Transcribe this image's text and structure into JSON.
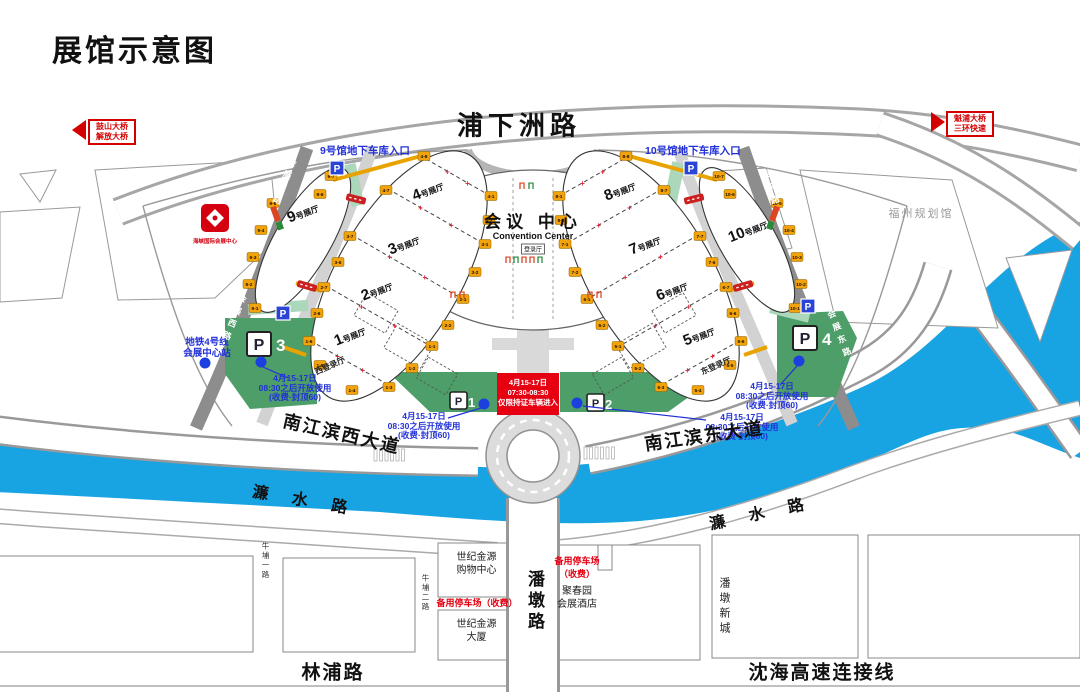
{
  "title": "展馆示意图",
  "signs": {
    "left": {
      "lines": [
        "鼓山大桥",
        "解放大桥"
      ]
    },
    "right": {
      "lines": [
        "魁浦大桥",
        "三环快速"
      ]
    }
  },
  "roads": {
    "puxiazhou": "浦下洲路",
    "njb_west": "南江滨西大道",
    "njb_east": "南江滨东大道",
    "lianshui": "濂水路",
    "linpu": "林浦路",
    "shenhai": "沈海高速连接线"
  },
  "center": {
    "cn": "会议 中心",
    "en": "Convention Center",
    "hall": "登录厅"
  },
  "entrances": {
    "west": "9号馆地下车库入口",
    "east": "10号馆地下车库入口"
  },
  "metro": {
    "lines": [
      "地铁4号线",
      "会展中心站"
    ]
  },
  "notice": {
    "lines": [
      "4月15-17日",
      "07:30-08:30",
      "仅限持证车辆进入"
    ]
  },
  "parking_note": {
    "lines": [
      "4月15-17日",
      "08:30之后开放使用",
      "(收费·封顶60)"
    ]
  },
  "parking": {
    "symbol": "P",
    "p1": "1",
    "p2": "2",
    "p3": "3",
    "p4": "4"
  },
  "buildings": {
    "planning": "福州规划馆",
    "shopping": [
      "世纪金源",
      "购物中心"
    ],
    "tower": [
      "世纪金源",
      "大厦"
    ],
    "hotel": [
      "聚春园",
      "会展酒店"
    ],
    "backup_h": "备用停车场（收费）",
    "backup_v": [
      "备用停车场",
      "（收费）"
    ]
  },
  "logo": {
    "caption": "海峡国际会展中心"
  },
  "colors": {
    "river": "#18A3E3",
    "green": "#4D9E68",
    "green_light": "#ABD7BA",
    "red": "#E60012",
    "blue_text": "#2230D8",
    "road_dark": "#8D8D8D",
    "gate_yellow": "#F2A20A"
  },
  "map": {
    "halls": [
      {
        "num": "9",
        "suffix": "号展厅",
        "x": 303,
        "y": 213,
        "rot": -22
      },
      {
        "num": "4",
        "suffix": "号展厅",
        "x": 428,
        "y": 191,
        "rot": -22
      },
      {
        "num": "3",
        "suffix": "号展厅",
        "x": 404,
        "y": 245,
        "rot": -22
      },
      {
        "num": "2",
        "suffix": "号展厅",
        "x": 377,
        "y": 291,
        "rot": -22
      },
      {
        "num": "1",
        "suffix": "号展厅",
        "x": 350,
        "y": 336,
        "rot": -22
      },
      {
        "num": "8",
        "suffix": "号展厅",
        "x": 620,
        "y": 191,
        "rot": -22
      },
      {
        "num": "7",
        "suffix": "号展厅",
        "x": 645,
        "y": 245,
        "rot": -22
      },
      {
        "num": "6",
        "suffix": "号展厅",
        "x": 672,
        "y": 291,
        "rot": -22
      },
      {
        "num": "5",
        "suffix": "号展厅",
        "x": 699,
        "y": 336,
        "rot": -22
      },
      {
        "num": "10",
        "suffix": "号展厅",
        "x": 748,
        "y": 231,
        "rot": -22
      }
    ],
    "reg_labels": [
      {
        "text": "西登录厅",
        "x": 330,
        "y": 366,
        "rot": -24
      },
      {
        "text": "东登录厅",
        "x": 716,
        "y": 366,
        "rot": -24
      }
    ],
    "dividers": [
      [
        426,
        159,
        487,
        194
      ],
      [
        388,
        189,
        481,
        242
      ],
      [
        352,
        235,
        459,
        297
      ],
      [
        326,
        286,
        427,
        344
      ],
      [
        311,
        341,
        387,
        384
      ],
      [
        624,
        159,
        563,
        194
      ],
      [
        662,
        189,
        569,
        242
      ],
      [
        698,
        235,
        591,
        297
      ],
      [
        724,
        286,
        623,
        344
      ],
      [
        739,
        341,
        663,
        384
      ]
    ],
    "corridors": [
      [
        333,
        180,
        421,
        156
      ],
      [
        296,
        283,
        322,
        291
      ],
      [
        283,
        347,
        306,
        355
      ],
      [
        717,
        180,
        629,
        156
      ],
      [
        754,
        283,
        728,
        291
      ],
      [
        767,
        347,
        744,
        355
      ]
    ],
    "red_bars": [
      {
        "x": 356,
        "y": 199,
        "rot": 14
      },
      {
        "x": 307,
        "y": 286,
        "rot": 16
      },
      {
        "x": 694,
        "y": 199,
        "rot": -14
      },
      {
        "x": 743,
        "y": 286,
        "rot": -16
      }
    ],
    "gates": [
      {
        "l": "9-1",
        "x": 255,
        "y": 308
      },
      {
        "l": "9-2",
        "x": 249,
        "y": 284
      },
      {
        "l": "9-3",
        "x": 253,
        "y": 257
      },
      {
        "l": "9-4",
        "x": 261,
        "y": 230
      },
      {
        "l": "9-5",
        "x": 273,
        "y": 203
      },
      {
        "l": "9-6",
        "x": 320,
        "y": 194
      },
      {
        "l": "9-7",
        "x": 331,
        "y": 176
      },
      {
        "l": "4-8",
        "x": 424,
        "y": 156
      },
      {
        "l": "4-7",
        "x": 386,
        "y": 190
      },
      {
        "l": "4-1",
        "x": 491,
        "y": 196
      },
      {
        "l": "4-2",
        "x": 489,
        "y": 220
      },
      {
        "l": "3-7",
        "x": 350,
        "y": 236
      },
      {
        "l": "3-6",
        "x": 338,
        "y": 262
      },
      {
        "l": "3-1",
        "x": 485,
        "y": 244
      },
      {
        "l": "3-2",
        "x": 475,
        "y": 272
      },
      {
        "l": "2-7",
        "x": 324,
        "y": 287
      },
      {
        "l": "2-6",
        "x": 317,
        "y": 313
      },
      {
        "l": "2-1",
        "x": 463,
        "y": 299
      },
      {
        "l": "2-2",
        "x": 448,
        "y": 325
      },
      {
        "l": "1-6",
        "x": 309,
        "y": 341
      },
      {
        "l": "1-5",
        "x": 320,
        "y": 365
      },
      {
        "l": "1-1",
        "x": 432,
        "y": 346
      },
      {
        "l": "1-2",
        "x": 412,
        "y": 368
      },
      {
        "l": "1-3",
        "x": 389,
        "y": 387
      },
      {
        "l": "1-4",
        "x": 352,
        "y": 390
      },
      {
        "l": "8-8",
        "x": 626,
        "y": 156
      },
      {
        "l": "8-7",
        "x": 664,
        "y": 190
      },
      {
        "l": "8-1",
        "x": 559,
        "y": 196
      },
      {
        "l": "8-2",
        "x": 561,
        "y": 220
      },
      {
        "l": "7-7",
        "x": 700,
        "y": 236
      },
      {
        "l": "7-6",
        "x": 712,
        "y": 262
      },
      {
        "l": "7-1",
        "x": 565,
        "y": 244
      },
      {
        "l": "7-2",
        "x": 575,
        "y": 272
      },
      {
        "l": "6-7",
        "x": 726,
        "y": 287
      },
      {
        "l": "6-6",
        "x": 733,
        "y": 313
      },
      {
        "l": "6-1",
        "x": 587,
        "y": 299
      },
      {
        "l": "6-2",
        "x": 602,
        "y": 325
      },
      {
        "l": "5-6",
        "x": 741,
        "y": 341
      },
      {
        "l": "5-5",
        "x": 730,
        "y": 365
      },
      {
        "l": "5-1",
        "x": 618,
        "y": 346
      },
      {
        "l": "5-2",
        "x": 638,
        "y": 368
      },
      {
        "l": "5-3",
        "x": 661,
        "y": 387
      },
      {
        "l": "5-4",
        "x": 698,
        "y": 390
      },
      {
        "l": "10-1",
        "x": 795,
        "y": 308
      },
      {
        "l": "10-2",
        "x": 801,
        "y": 284
      },
      {
        "l": "10-3",
        "x": 797,
        "y": 257
      },
      {
        "l": "10-4",
        "x": 789,
        "y": 230
      },
      {
        "l": "10-5",
        "x": 777,
        "y": 203
      },
      {
        "l": "10-6",
        "x": 730,
        "y": 194
      },
      {
        "l": "10-7",
        "x": 719,
        "y": 176
      }
    ],
    "vertical_labels": [
      {
        "text": "会展西路",
        "x": 288,
        "y": 158,
        "rot": 22,
        "size": 8.5,
        "color": "#ffffff",
        "ls": 5,
        "bold": true
      },
      {
        "text": "会展西路",
        "x": 238,
        "y": 294,
        "rot": 22,
        "size": 8.5,
        "color": "#ffffff",
        "ls": 5,
        "bold": true
      },
      {
        "text": "会展东路",
        "x": 752,
        "y": 158,
        "rot": -22,
        "size": 8.5,
        "color": "#ffffff",
        "ls": 5,
        "bold": true
      },
      {
        "text": "会展东路",
        "x": 824,
        "y": 310,
        "rot": -22,
        "size": 8.5,
        "color": "#ffffff",
        "ls": 5,
        "bold": true
      },
      {
        "text": "潘墩路",
        "x": 522,
        "y": 570,
        "rot": 0,
        "size": 17,
        "color": "#111111",
        "ls": 4,
        "bold": true
      },
      {
        "text": "潘墩新城",
        "x": 716,
        "y": 577,
        "rot": 0,
        "size": 11,
        "color": "#222222",
        "ls": 4,
        "bold": false
      },
      {
        "text": "牛埔一路",
        "x": 260,
        "y": 542,
        "rot": 0,
        "size": 7.5,
        "color": "#333333",
        "ls": 2,
        "bold": false
      },
      {
        "text": "牛埔二路",
        "x": 420,
        "y": 574,
        "rot": 0,
        "size": 7.5,
        "color": "#333333",
        "ls": 2,
        "bold": false
      }
    ]
  }
}
